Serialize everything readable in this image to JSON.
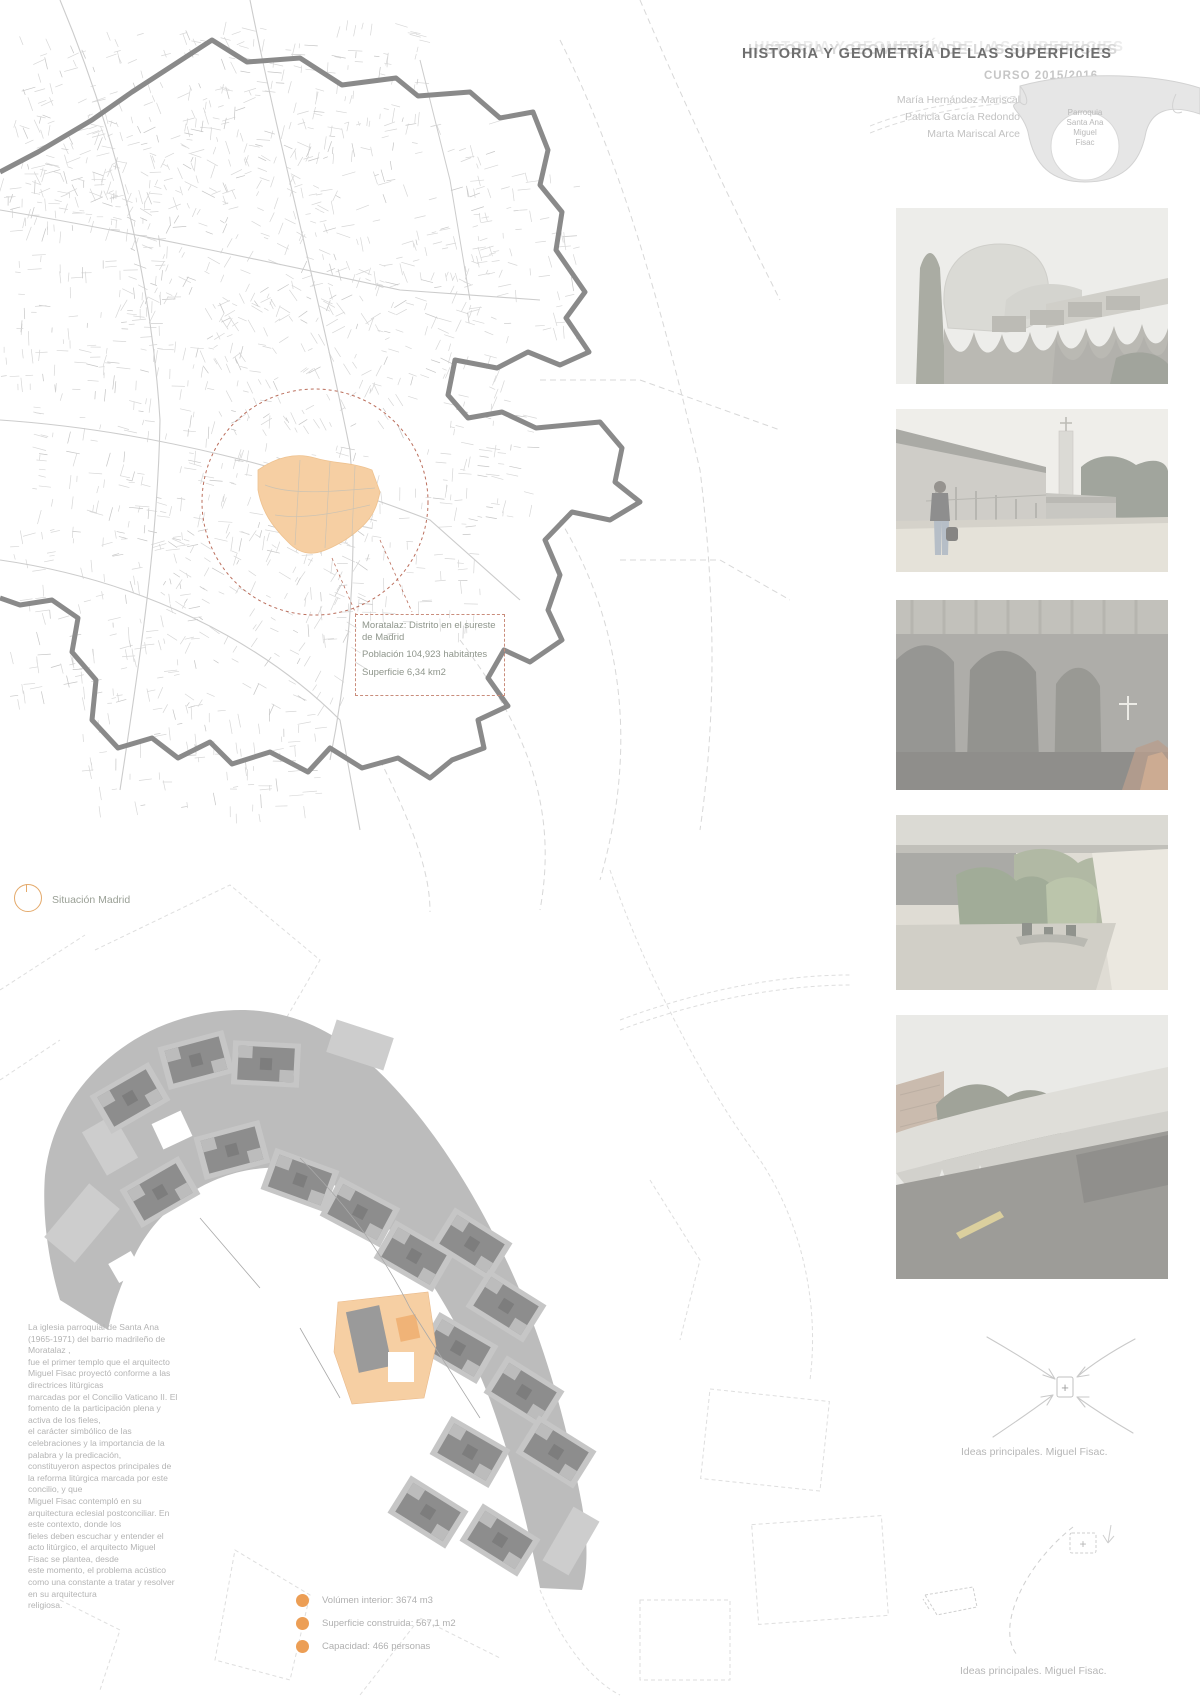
{
  "poster": {
    "title": "HISTORIA Y GEOMETRÍA DE LAS SUPERFICIES",
    "course": "CURSO 2015/2016",
    "authors": "María Hernández Mariscal\nPatricia García Redondo\nMarta Mariscal Arce",
    "project_label": "Parroquia\nSanta Ana\nMiguel\nFisac"
  },
  "map": {
    "info_box": {
      "line1": "Moratalaz: Distrito en el sureste de Madrid",
      "line2": "Población 104,923 habitantes",
      "line3": "Superficie 6,34 km2"
    },
    "caption": "Situación Madrid"
  },
  "description": "La iglesia parroquial de Santa Ana\n(1965-1971) del barrio madrileño de\nMoratalaz ,\nfue el primer templo que el arquitecto\nMiguel Fisac proyectó conforme a las\ndirectrices litúrgicas\nmarcadas por el Concilio Vaticano II. El\nfomento de la participación plena y\nactiva de los fieles,\nel carácter simbólico de las\ncelebraciones y la importancia de la\npalabra y la predicación,\nconstituyeron aspectos principales de\nla reforma litúrgica marcada por este\nconcilio, y que\nMiguel Fisac contempló en su\narquitectura eclesial postconciliar. En\neste contexto, donde los\nfieles deben escuchar y entender el\nacto litúrgico, el arquitecto Miguel\nFisac se plantea, desde\neste momento, el problema acústico\ncomo una constante a tratar y resolver\nen su arquitectura\nreligiosa.",
  "legend": {
    "dot_color": "#ec9e55",
    "items": [
      {
        "label": "Volúmen interior: 3674 m3"
      },
      {
        "label": "Superficie construida: 567,1 m2"
      },
      {
        "label": "Capacidad: 466 personas"
      }
    ]
  },
  "sketches": {
    "cross": "+",
    "caption1": "Ideas principales. Miguel Fisac.",
    "caption2": "Ideas principales. Miguel Fisac."
  },
  "colors": {
    "accent_orange": "#ec9e55",
    "district_fill": "#f6cfa3",
    "dashed_red": "#bb6f5d",
    "boundary_gray": "#8a8a8a"
  },
  "photos": [
    {
      "name": "church-exterior-wavy-roof"
    },
    {
      "name": "courtyard-bell-tower"
    },
    {
      "name": "interior-concrete-arches-crucifix"
    },
    {
      "name": "garden-under-concrete-canopy"
    },
    {
      "name": "wavy-roof-underside-trees"
    }
  ]
}
